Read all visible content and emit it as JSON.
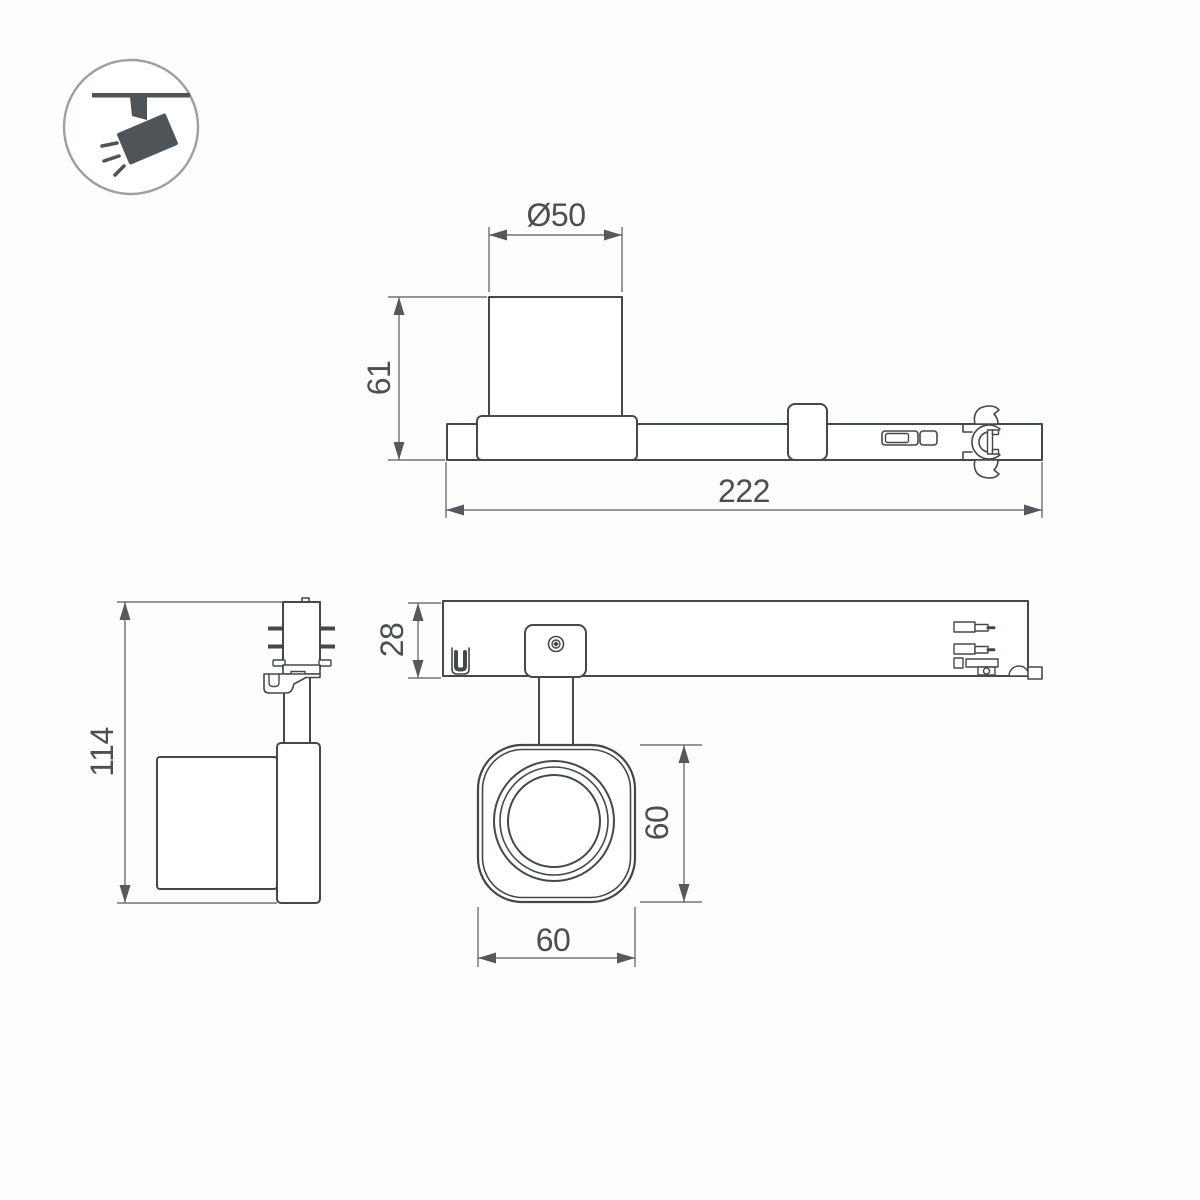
{
  "theme": {
    "bg": "#fdfdfd",
    "line": "#43484d",
    "dim": "#55595e",
    "text": "#4a4f53",
    "icon-dark": "#4e5458",
    "icon-ring": "#9ba0a5"
  },
  "icon": {
    "name": "track-spotlight-icon"
  },
  "views": {
    "front": {
      "dims": {
        "diameter": "Ø50",
        "height": "61",
        "length": "222"
      }
    },
    "side": {
      "dims": {
        "height": "114"
      }
    },
    "top": {
      "dims": {
        "rail_width": "28",
        "head_height": "60",
        "head_width": "60"
      }
    }
  }
}
